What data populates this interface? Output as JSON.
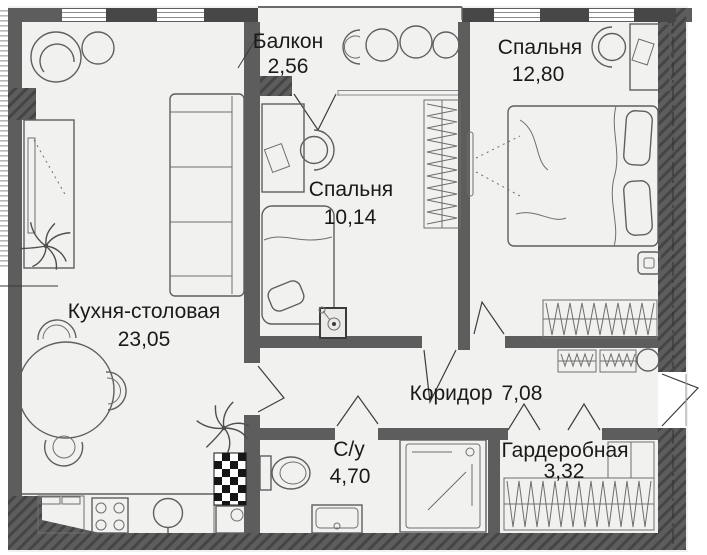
{
  "plan": {
    "type": "apartment-floor-plan",
    "rooms": [
      {
        "name": "Балкон",
        "area": "2,56"
      },
      {
        "name": "Спальня",
        "area": "12,80"
      },
      {
        "name": "Спальня",
        "area": "10,14"
      },
      {
        "name": "Кухня-столовая",
        "area": "23,05"
      },
      {
        "name": "Коридор",
        "area": "7,08"
      },
      {
        "name": "С/у",
        "area": "4,70"
      },
      {
        "name": "Гардеробная",
        "area": "3,32"
      }
    ],
    "colors": {
      "wall": "#5d5d5d",
      "wall_dark": "#474747",
      "wall_hatch": "#454545",
      "floor": "#f1f1ef",
      "furniture_line": "#5f5f5f",
      "text": "#1a1a1a",
      "background": "#ffffff"
    }
  }
}
